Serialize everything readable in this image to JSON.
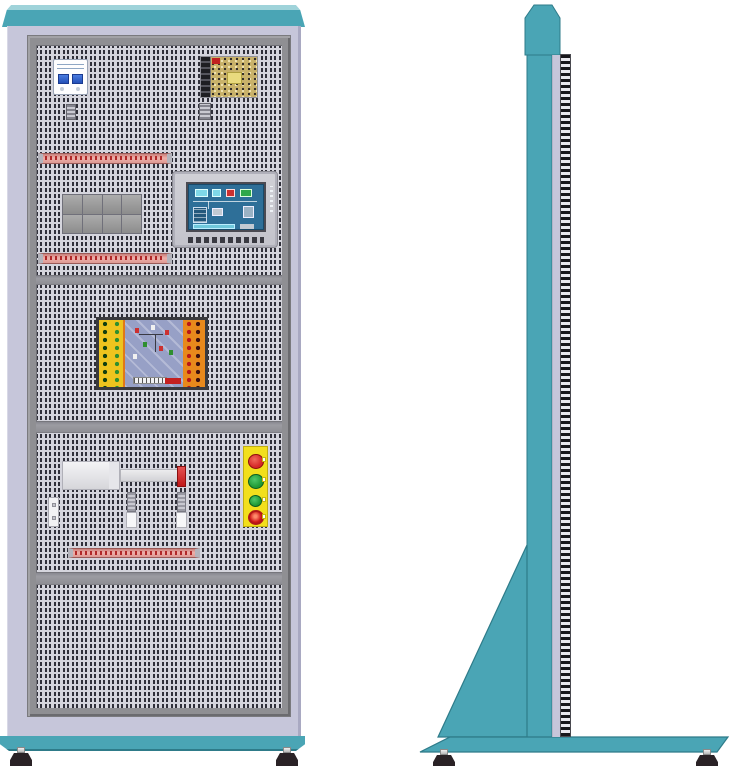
{
  "illustration": {
    "title": "electrical-training-cabinet-two-view-drawing",
    "views": [
      {
        "id": "front",
        "label": "front elevation"
      },
      {
        "id": "side",
        "label": "side elevation"
      }
    ],
    "front_components": [
      {
        "name": "circuit-breaker",
        "detail": "2-pole MCB, white body, blue toggles"
      },
      {
        "name": "switching-power-supply",
        "detail": "open-frame PSU, terminal block, PCB, transformer"
      },
      {
        "name": "din-rail-end-clamp",
        "count": 2
      },
      {
        "name": "terminal-block-strip",
        "count": 3,
        "detail": "pink terminal rows with red screw dots"
      },
      {
        "name": "relay-module-block",
        "detail": "2x4 grey relay grid"
      },
      {
        "name": "hmi-touch-panel",
        "detail": "grey bezel, blue process screen, function key row"
      },
      {
        "name": "plc-trainer-board",
        "detail": "yellow and orange I/O columns, blue PCB center, red label"
      },
      {
        "name": "pneumatic-cylinder",
        "detail": "body, piston rod, red end cap"
      },
      {
        "name": "mounting-bracket",
        "count": 1
      },
      {
        "name": "sensor-post",
        "count": 2
      },
      {
        "name": "push-button-station",
        "buttons": [
          "red",
          "green",
          "green",
          "emergency-stop"
        ]
      },
      {
        "name": "leveling-foot",
        "count": 2
      }
    ],
    "side_components": [
      {
        "name": "upright-column"
      },
      {
        "name": "chamfered-top-cap"
      },
      {
        "name": "louvered-edge-strip"
      },
      {
        "name": "triangular-gusset"
      },
      {
        "name": "floor-base-plate"
      },
      {
        "name": "leveling-foot",
        "count": 2
      }
    ]
  },
  "palette": {
    "teal": "#4aa5b5",
    "teal_light": "#9fd3da",
    "teal_dark": "#2e7b89",
    "lavender": "#c6c6da",
    "lavender_dark": "#a9a9c2",
    "bezel": "#8f8f93",
    "bezel_dark": "#6b6b6f",
    "panel_bg": "#d5d5dd",
    "perforation": "#30303a",
    "divider": "#9c9ca2",
    "terminal_body": "#eeb0aa",
    "terminal_red": "#b02828",
    "metal": "#b4b4bc",
    "relay": "#9b9b9b",
    "screen_blue": "#2e6f98",
    "hmi_bezel": "#c3c3cb",
    "plc_frame": "#3a3a3e",
    "plc_yellow": "#eec41e",
    "plc_orange": "#e8891c",
    "pcb_blue": "#97a0c6",
    "psu_pcb": "#c9b26a",
    "station_yellow": "#f2df1c",
    "btn_red": "#d42626",
    "btn_green": "#1f9935",
    "foot_dark": "#2a2226"
  }
}
